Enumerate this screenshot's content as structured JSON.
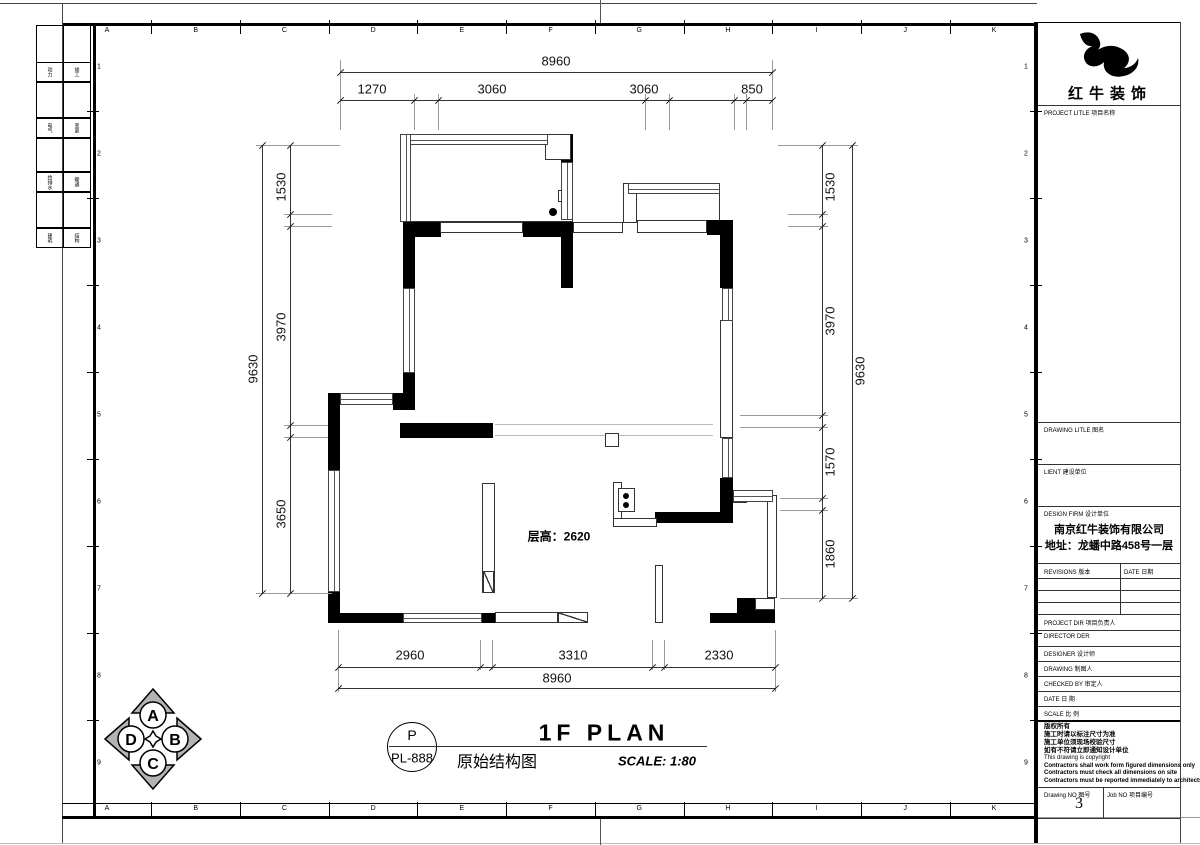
{
  "colors": {
    "line": "#000",
    "dim_line": "#333",
    "ext_line": "#9a9a9a",
    "compass_fill": "#b3b3b3"
  },
  "frame": {
    "col_letters": [
      "A",
      "B",
      "C",
      "D",
      "E",
      "F",
      "G",
      "H",
      "I",
      "J",
      "K"
    ],
    "row_numbers": [
      "1",
      "2",
      "3",
      "4",
      "5",
      "6",
      "7",
      "8",
      "9"
    ]
  },
  "stamp_strip": {
    "rows": [
      [
        "动力",
        "竣工"
      ],
      [
        "电气",
        "变更"
      ],
      [
        "给排水",
        "暖通"
      ],
      [
        "建筑",
        "结构"
      ]
    ]
  },
  "plan": {
    "floor_height_label": "层高：2620",
    "dims": {
      "top": {
        "overall": "8960",
        "segs": [
          "1270",
          "3060",
          "3060",
          "850"
        ]
      },
      "bottom": {
        "overall": "8960",
        "segs": [
          "2960",
          "3310",
          "2330"
        ]
      },
      "left": {
        "overall": "9630",
        "segs": [
          "1530",
          "3970",
          "3650"
        ]
      },
      "right": {
        "overall": "9630",
        "segs": [
          "1530",
          "3970",
          "1570",
          "1860"
        ]
      }
    }
  },
  "title_bar": {
    "bubble_top": "P",
    "bubble_bottom": "PL-888",
    "title_en": "1F PLAN",
    "title_cn": "原始结构图",
    "scale": "SCALE: 1:80"
  },
  "compass": {
    "n": "A",
    "e": "B",
    "s": "C",
    "w": "D"
  },
  "title_block": {
    "logo_text": "红牛装饰",
    "project_label": "PROJECT LITLE  项目名称",
    "drawing_label": "DRAWING LITLE  图名",
    "client_label": "LIENT  建设单位",
    "firm_label": "DESIGN FIRM  设计单位",
    "firm_name": "南京红牛装饰有限公司",
    "firm_address": "地址：龙蟠中路458号一层",
    "revisions_header": "REVISIONS  版本",
    "date_header": "DATE  日期",
    "rows": [
      "PROJECT DIR   项目负责人",
      "DIRECTOR DER",
      "DESIGNER      设计师",
      "DRAWING       制图人",
      "CHECKED BY   审定人",
      "DATE             日  期",
      "SCALE           比  例"
    ],
    "notes": [
      "版权所有",
      "施工时请以标注尺寸为准",
      "施工单位须现场校验尺寸",
      "如有不符请立即通知设计单位",
      "This drawing is copyright",
      "Contractors shall work form figured dimensions only",
      "Contractors must check all dimensions on site",
      "Contractors must be reported immediately to architects"
    ],
    "drawing_no_label": "Drawing NO  图号",
    "drawing_no": "3",
    "job_no_label": "Job NO  项目编号"
  },
  "geometry": {
    "rooms": [
      [
        400,
        134,
        173,
        88
      ],
      [
        623,
        183,
        97,
        40
      ],
      [
        623,
        183,
        14,
        40
      ]
    ],
    "walls": [
      [
        403,
        222,
        38,
        15
      ],
      [
        523,
        222,
        50,
        15
      ],
      [
        403,
        237,
        12,
        51
      ],
      [
        561,
        237,
        12,
        51
      ],
      [
        561,
        134,
        12,
        30
      ],
      [
        707,
        220,
        26,
        15
      ],
      [
        720,
        235,
        13,
        53
      ],
      [
        720,
        478,
        13,
        45
      ],
      [
        655,
        512,
        78,
        11
      ],
      [
        328,
        393,
        12,
        77
      ],
      [
        328,
        592,
        12,
        31
      ],
      [
        393,
        393,
        22,
        17
      ],
      [
        403,
        373,
        12,
        20
      ],
      [
        400,
        423,
        93,
        15
      ],
      [
        328,
        613,
        75,
        10
      ],
      [
        482,
        613,
        13,
        10
      ],
      [
        737,
        598,
        38,
        25
      ],
      [
        710,
        613,
        65,
        10
      ]
    ],
    "thin_rects": [
      [
        573,
        222,
        50,
        11
      ],
      [
        637,
        220,
        70,
        13
      ],
      [
        720,
        320,
        13,
        118
      ],
      [
        482,
        483,
        13,
        110
      ],
      [
        613,
        482,
        9,
        45
      ],
      [
        613,
        518,
        44,
        9
      ],
      [
        655,
        565,
        8,
        58
      ],
      [
        767,
        495,
        10,
        103
      ],
      [
        495,
        612,
        63,
        11
      ],
      [
        605,
        433,
        14,
        14
      ],
      [
        618,
        488,
        17,
        24
      ],
      [
        440,
        222,
        83,
        11
      ],
      [
        545,
        134,
        26,
        26
      ],
      [
        558,
        190,
        15,
        12
      ],
      [
        755,
        598,
        20,
        12
      ],
      [
        733,
        492,
        14,
        11
      ]
    ],
    "windows_h": [
      [
        400,
        134,
        148,
        11
      ],
      [
        628,
        183,
        92,
        11
      ],
      [
        340,
        393,
        53,
        12
      ],
      [
        403,
        613,
        79,
        10
      ],
      [
        733,
        490,
        40,
        12
      ]
    ],
    "windows_v": [
      [
        400,
        134,
        11,
        88
      ],
      [
        561,
        162,
        12,
        58
      ],
      [
        403,
        288,
        12,
        85
      ],
      [
        722,
        288,
        11,
        33
      ],
      [
        722,
        438,
        11,
        40
      ],
      [
        328,
        470,
        12,
        122
      ]
    ],
    "hatches": [
      [
        558,
        612,
        30,
        11
      ],
      [
        483,
        571,
        11,
        22
      ]
    ],
    "dots": [
      [
        553,
        212,
        4
      ],
      [
        750,
        606,
        4
      ],
      [
        626,
        496,
        3
      ],
      [
        626,
        505,
        3
      ]
    ],
    "light_lines": [
      [
        495,
        424,
        218,
        1
      ],
      [
        495,
        435,
        218,
        1
      ]
    ],
    "dim_lines": [
      [
        340,
        72,
        432,
        1
      ],
      [
        340,
        100,
        432,
        1
      ],
      [
        262,
        145,
        1,
        448
      ],
      [
        290,
        145,
        1,
        448
      ],
      [
        822,
        145,
        1,
        453
      ],
      [
        852,
        145,
        1,
        453
      ],
      [
        338,
        667,
        437,
        1
      ],
      [
        338,
        688,
        437,
        1
      ]
    ],
    "ticks": [
      [
        340,
        72
      ],
      [
        772,
        72
      ],
      [
        340,
        100
      ],
      [
        414,
        100
      ],
      [
        438,
        100
      ],
      [
        645,
        100
      ],
      [
        669,
        100
      ],
      [
        734,
        100
      ],
      [
        746,
        100
      ],
      [
        772,
        100
      ],
      [
        262,
        145
      ],
      [
        262,
        593
      ],
      [
        290,
        145
      ],
      [
        290,
        214
      ],
      [
        290,
        226
      ],
      [
        290,
        425
      ],
      [
        290,
        437
      ],
      [
        290,
        593
      ],
      [
        822,
        145
      ],
      [
        822,
        214
      ],
      [
        822,
        226
      ],
      [
        822,
        415
      ],
      [
        822,
        427
      ],
      [
        822,
        498
      ],
      [
        822,
        510
      ],
      [
        822,
        598
      ],
      [
        852,
        145
      ],
      [
        852,
        598
      ],
      [
        338,
        667
      ],
      [
        480,
        667
      ],
      [
        492,
        667
      ],
      [
        652,
        667
      ],
      [
        664,
        667
      ],
      [
        775,
        667
      ],
      [
        338,
        688
      ],
      [
        775,
        688
      ]
    ],
    "ext_lines": [
      [
        340,
        60,
        1,
        70
      ],
      [
        772,
        60,
        1,
        70
      ],
      [
        414,
        94,
        1,
        36
      ],
      [
        438,
        94,
        1,
        36
      ],
      [
        645,
        94,
        1,
        36
      ],
      [
        669,
        94,
        1,
        36
      ],
      [
        734,
        94,
        1,
        36
      ],
      [
        746,
        94,
        1,
        36
      ],
      [
        338,
        630,
        1,
        62
      ],
      [
        480,
        640,
        1,
        30
      ],
      [
        492,
        640,
        1,
        30
      ],
      [
        652,
        640,
        1,
        30
      ],
      [
        664,
        640,
        1,
        30
      ],
      [
        775,
        630,
        1,
        62
      ],
      [
        256,
        145,
        84,
        1
      ],
      [
        284,
        214,
        48,
        1
      ],
      [
        284,
        226,
        48,
        1
      ],
      [
        284,
        425,
        44,
        1
      ],
      [
        284,
        437,
        44,
        1
      ],
      [
        256,
        593,
        76,
        1
      ],
      [
        778,
        145,
        80,
        1
      ],
      [
        788,
        214,
        40,
        1
      ],
      [
        788,
        226,
        40,
        1
      ],
      [
        740,
        415,
        88,
        1
      ],
      [
        740,
        427,
        88,
        1
      ],
      [
        780,
        498,
        48,
        1
      ],
      [
        780,
        510,
        48,
        1
      ],
      [
        780,
        598,
        78,
        1
      ]
    ],
    "frame_lines": [
      [
        "#444",
        0,
        3,
        1037,
        1
      ],
      [
        "#000",
        62,
        23,
        975,
        3
      ],
      [
        "#444",
        62,
        3,
        1,
        840
      ],
      [
        "#000",
        93,
        23,
        3,
        796
      ],
      [
        "#000",
        62,
        803,
        975,
        1
      ],
      [
        "#000",
        62,
        816,
        975,
        3
      ],
      [
        "#999",
        1037,
        817,
        163,
        1
      ],
      [
        "#bbb",
        0,
        843,
        1200,
        1
      ],
      [
        "#555",
        600,
        0,
        1,
        23
      ],
      [
        "#555",
        600,
        819,
        1,
        26
      ],
      [
        "#000",
        1034,
        22,
        4,
        821
      ],
      [
        "#000",
        1036,
        22,
        145,
        1
      ],
      [
        "#444",
        1180,
        22,
        1,
        821
      ]
    ],
    "tb_lines": [
      [
        1038,
        105,
        142,
        1
      ],
      [
        1038,
        422,
        142,
        1
      ],
      [
        1038,
        464,
        142,
        1
      ],
      [
        1038,
        506,
        142,
        1
      ],
      [
        1038,
        563,
        142,
        1
      ],
      [
        1038,
        578,
        142,
        1
      ],
      [
        1038,
        590,
        142,
        1
      ],
      [
        1038,
        602,
        142,
        1
      ],
      [
        1038,
        614,
        142,
        1
      ],
      [
        1038,
        630,
        142,
        1
      ],
      [
        1038,
        646,
        142,
        1
      ],
      [
        1038,
        661,
        142,
        1
      ],
      [
        1038,
        676,
        142,
        1
      ],
      [
        1038,
        691,
        142,
        1
      ],
      [
        1038,
        706,
        142,
        1
      ],
      [
        1038,
        787,
        142,
        1
      ],
      [
        1038,
        818,
        142,
        1
      ]
    ],
    "tb_vlines": [
      [
        1120,
        563,
        1,
        51
      ],
      [
        1103,
        787,
        1,
        31
      ]
    ],
    "tb_thick": [
      1038,
      720,
      142,
      2
    ],
    "stamp_row_heights": [
      38,
      20,
      36,
      20,
      34,
      20,
      36,
      20
    ]
  }
}
